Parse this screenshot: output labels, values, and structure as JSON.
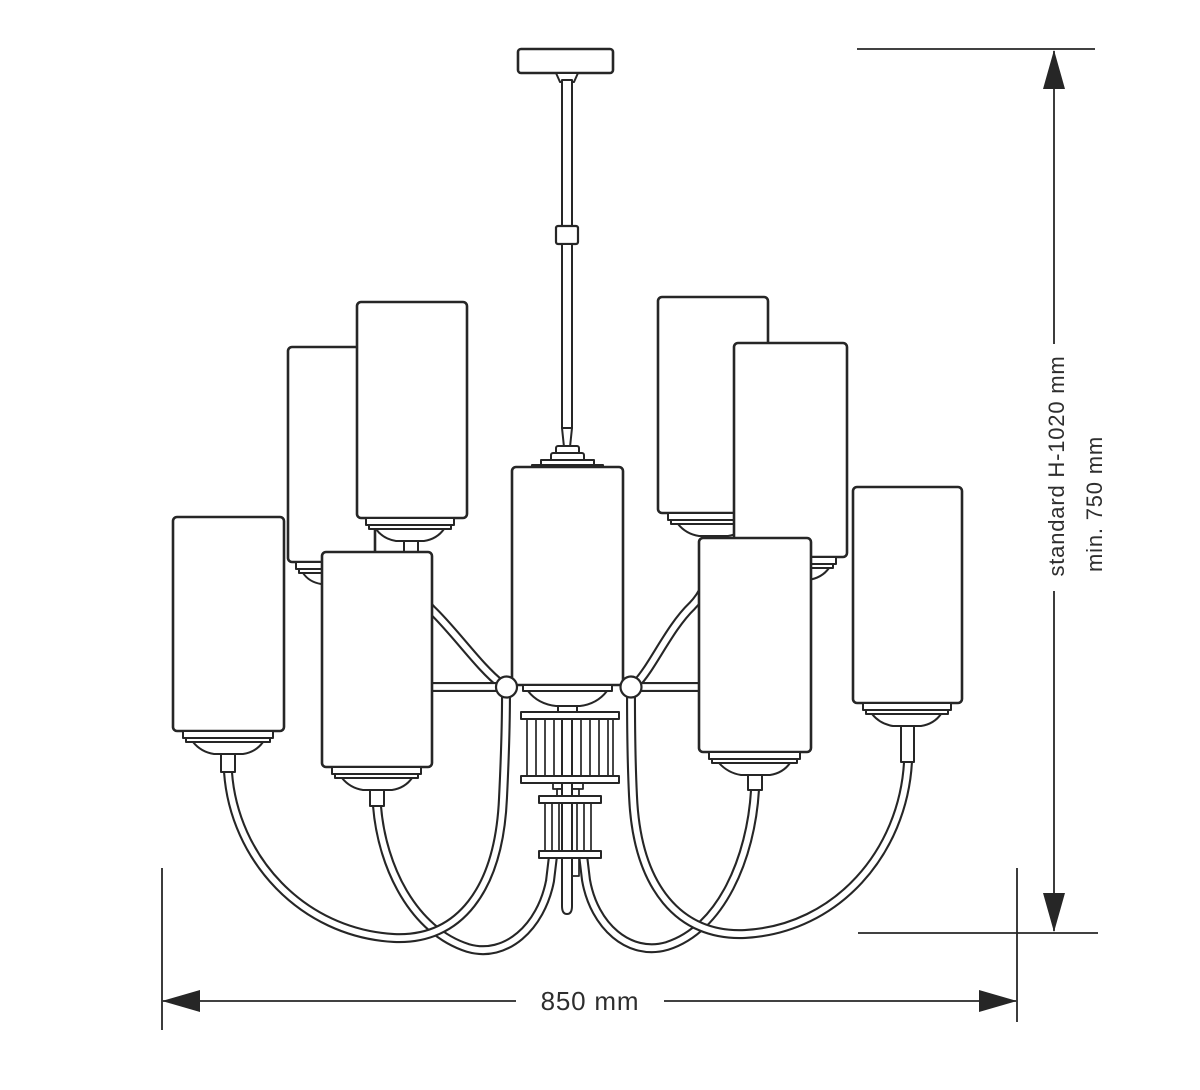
{
  "diagram": {
    "colors": {
      "line": "#262626",
      "text": "#2e2e2e",
      "background": "#ffffff"
    },
    "dimensions": {
      "height_standard_label": "standard H-1020 mm",
      "height_min_label": "min. 750 mm",
      "width_label": "850 mm"
    },
    "structure": {
      "upper_tier_shades_visible": 4,
      "lower_tier_shades_visible": 4,
      "central_shades_visible": 1
    }
  }
}
